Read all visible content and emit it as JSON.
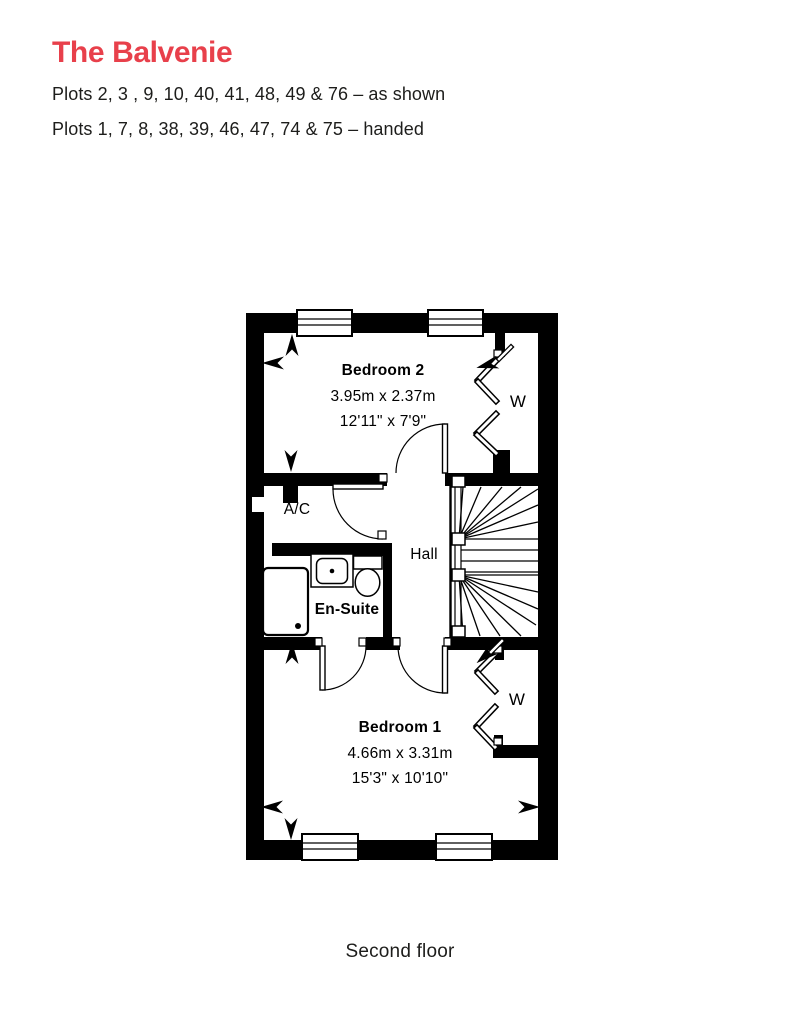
{
  "page": {
    "title": "The Balvenie",
    "subtitle_line1": "Plots 2, 3 , 9, 10, 40, 41, 48, 49 & 76 – as shown",
    "subtitle_line2": "Plots 1, 7, 8, 38, 39, 46, 47, 74 & 75 – handed",
    "floor_label": "Second floor",
    "accent_color": "#e8404b"
  },
  "floorplan": {
    "labels": {
      "bedroom2_name": "Bedroom 2",
      "bedroom2_metric": "3.95m x 2.37m",
      "bedroom2_imperial": "12'11\" x 7'9\"",
      "wardrobe2": "W",
      "ac": "A/C",
      "hall": "Hall",
      "ensuite": "En-Suite",
      "bedroom1_name": "Bedroom 1",
      "bedroom1_metric": "4.66m x 3.31m",
      "bedroom1_imperial": "15'3\" x 10'10\"",
      "wardrobe1": "W"
    }
  }
}
